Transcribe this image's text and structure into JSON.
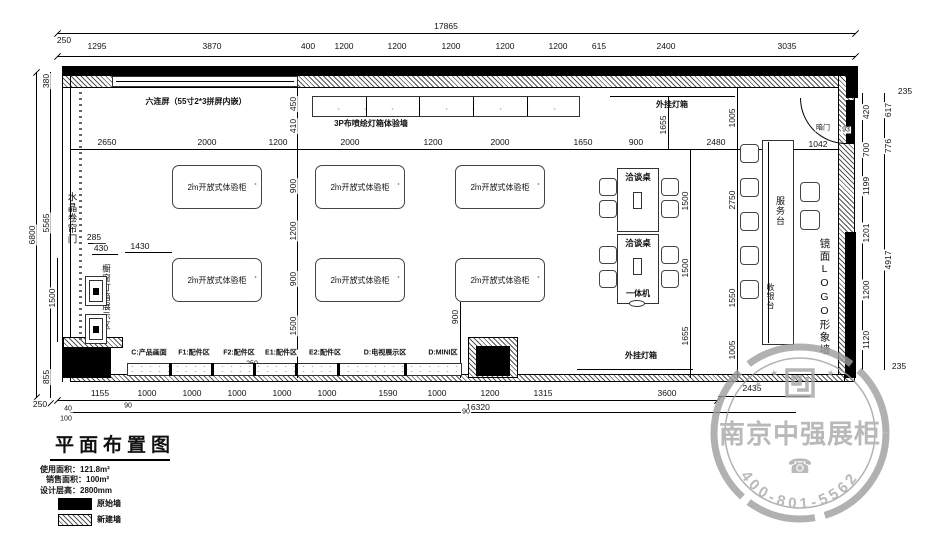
{
  "labels": {
    "six_screen": "六连屏（55寸2*3拼屏内嵌）",
    "spray_wall": "3P布喷绘灯箱体验墙",
    "hanging_lightbox_top": "外挂灯箱",
    "hanging_lightbox_bottom": "外挂灯箱",
    "crystal_door": "水晶卷帘门",
    "showcase_area": "橱窗灯箱展示区",
    "open_cabinet": "2m开放式体验柜",
    "meeting_table": "洽谈桌",
    "all_in_one": "一体机",
    "service_desk": "服务台",
    "cashier": "收银台",
    "mirror_logo_wall": "镜面LOGO形象墙",
    "hidden_door": "暗门"
  },
  "zones": [
    "C:产品画面",
    "F1:配件区",
    "F2:配件区",
    "E1:配件区",
    "E2:配件区",
    "D:电视展示区",
    "D:MINI区"
  ],
  "dims": {
    "total_width": "17865",
    "total_height": "6800",
    "top": [
      "250",
      "1295",
      "3870",
      "400",
      "1200",
      "1200",
      "1200",
      "1200",
      "1200",
      "615",
      "2400",
      "3035"
    ],
    "inner_top": [
      "2650",
      "2000",
      "1200",
      "2000",
      "1200",
      "2000",
      "1650",
      "900",
      "2480",
      "650",
      "1042"
    ],
    "left": [
      "380",
      "5565",
      "855"
    ],
    "center": [
      "450",
      "410",
      "900",
      "1200",
      "900",
      "1500"
    ],
    "right_inner": [
      "420",
      "700",
      "1199",
      "1201",
      "1200",
      "1120"
    ],
    "right_outer": [
      "617",
      "776",
      "4917"
    ],
    "bottom": [
      "1155",
      "1000",
      "1000",
      "1000",
      "1000",
      "1000",
      "1590",
      "1000",
      "1200",
      "1315",
      "3600"
    ],
    "misc": {
      "d1430": "1430",
      "d285": "285",
      "d430": "430",
      "d1500L": "1500",
      "d900c": "900",
      "d250s": "250",
      "d1655t": "1655",
      "d1005t": "1005",
      "d1500a": "1500",
      "d1500b": "1500",
      "d1655b": "1655",
      "d2750": "2750",
      "d1550": "1550",
      "d1005b": "1005",
      "d2435": "2435",
      "d16320": "16320",
      "d93": "93",
      "c235t": "235",
      "c235b": "235",
      "d90a": "90",
      "d90b": "90",
      "d40": "40",
      "d100": "100",
      "d250bl": "250"
    }
  },
  "title_block": {
    "title": "平面布置图",
    "area_use": "使用面积：121.8m²",
    "area_sale": "销售面积：100m²",
    "design_height": "设计层高：2800mm",
    "legend_original": "原始墙",
    "legend_new": "新建墙"
  },
  "watermark": {
    "company": "南京中强展柜",
    "phone": "400-801-5562",
    "phone_icon": "☎",
    "star": "★"
  }
}
